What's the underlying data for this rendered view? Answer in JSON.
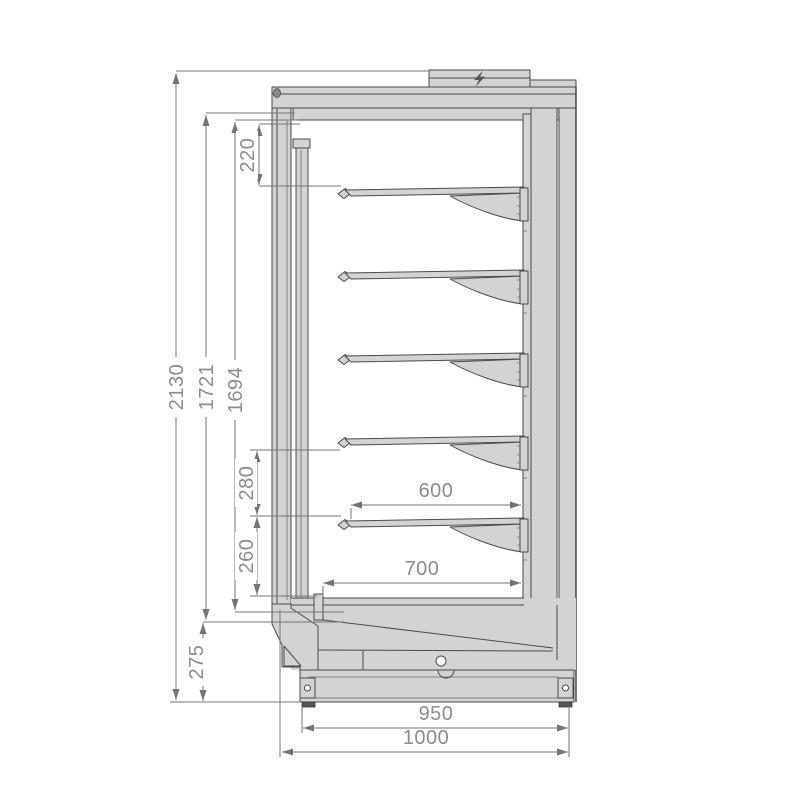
{
  "drawing": {
    "type": "technical-section-drawing",
    "shelf_count": 5,
    "dimensions": {
      "overall_height": "2130",
      "upper_height": "1721",
      "interior_height": "1694",
      "top_gap": "220",
      "shelf_spacing_upper": "280",
      "shelf_spacing_lower": "260",
      "base_height": "275",
      "shelf_depth": "600",
      "bottom_deck_depth": "700",
      "base_depth": "950",
      "overall_depth": "1000"
    },
    "icons": {
      "power": "lightning-bolt"
    },
    "colors": {
      "body_fill": "#d3d3d3",
      "outline": "#4a4a4a",
      "dimension_line": "#757575",
      "dimension_text": "#8c8c8c",
      "background": "#ffffff"
    }
  }
}
